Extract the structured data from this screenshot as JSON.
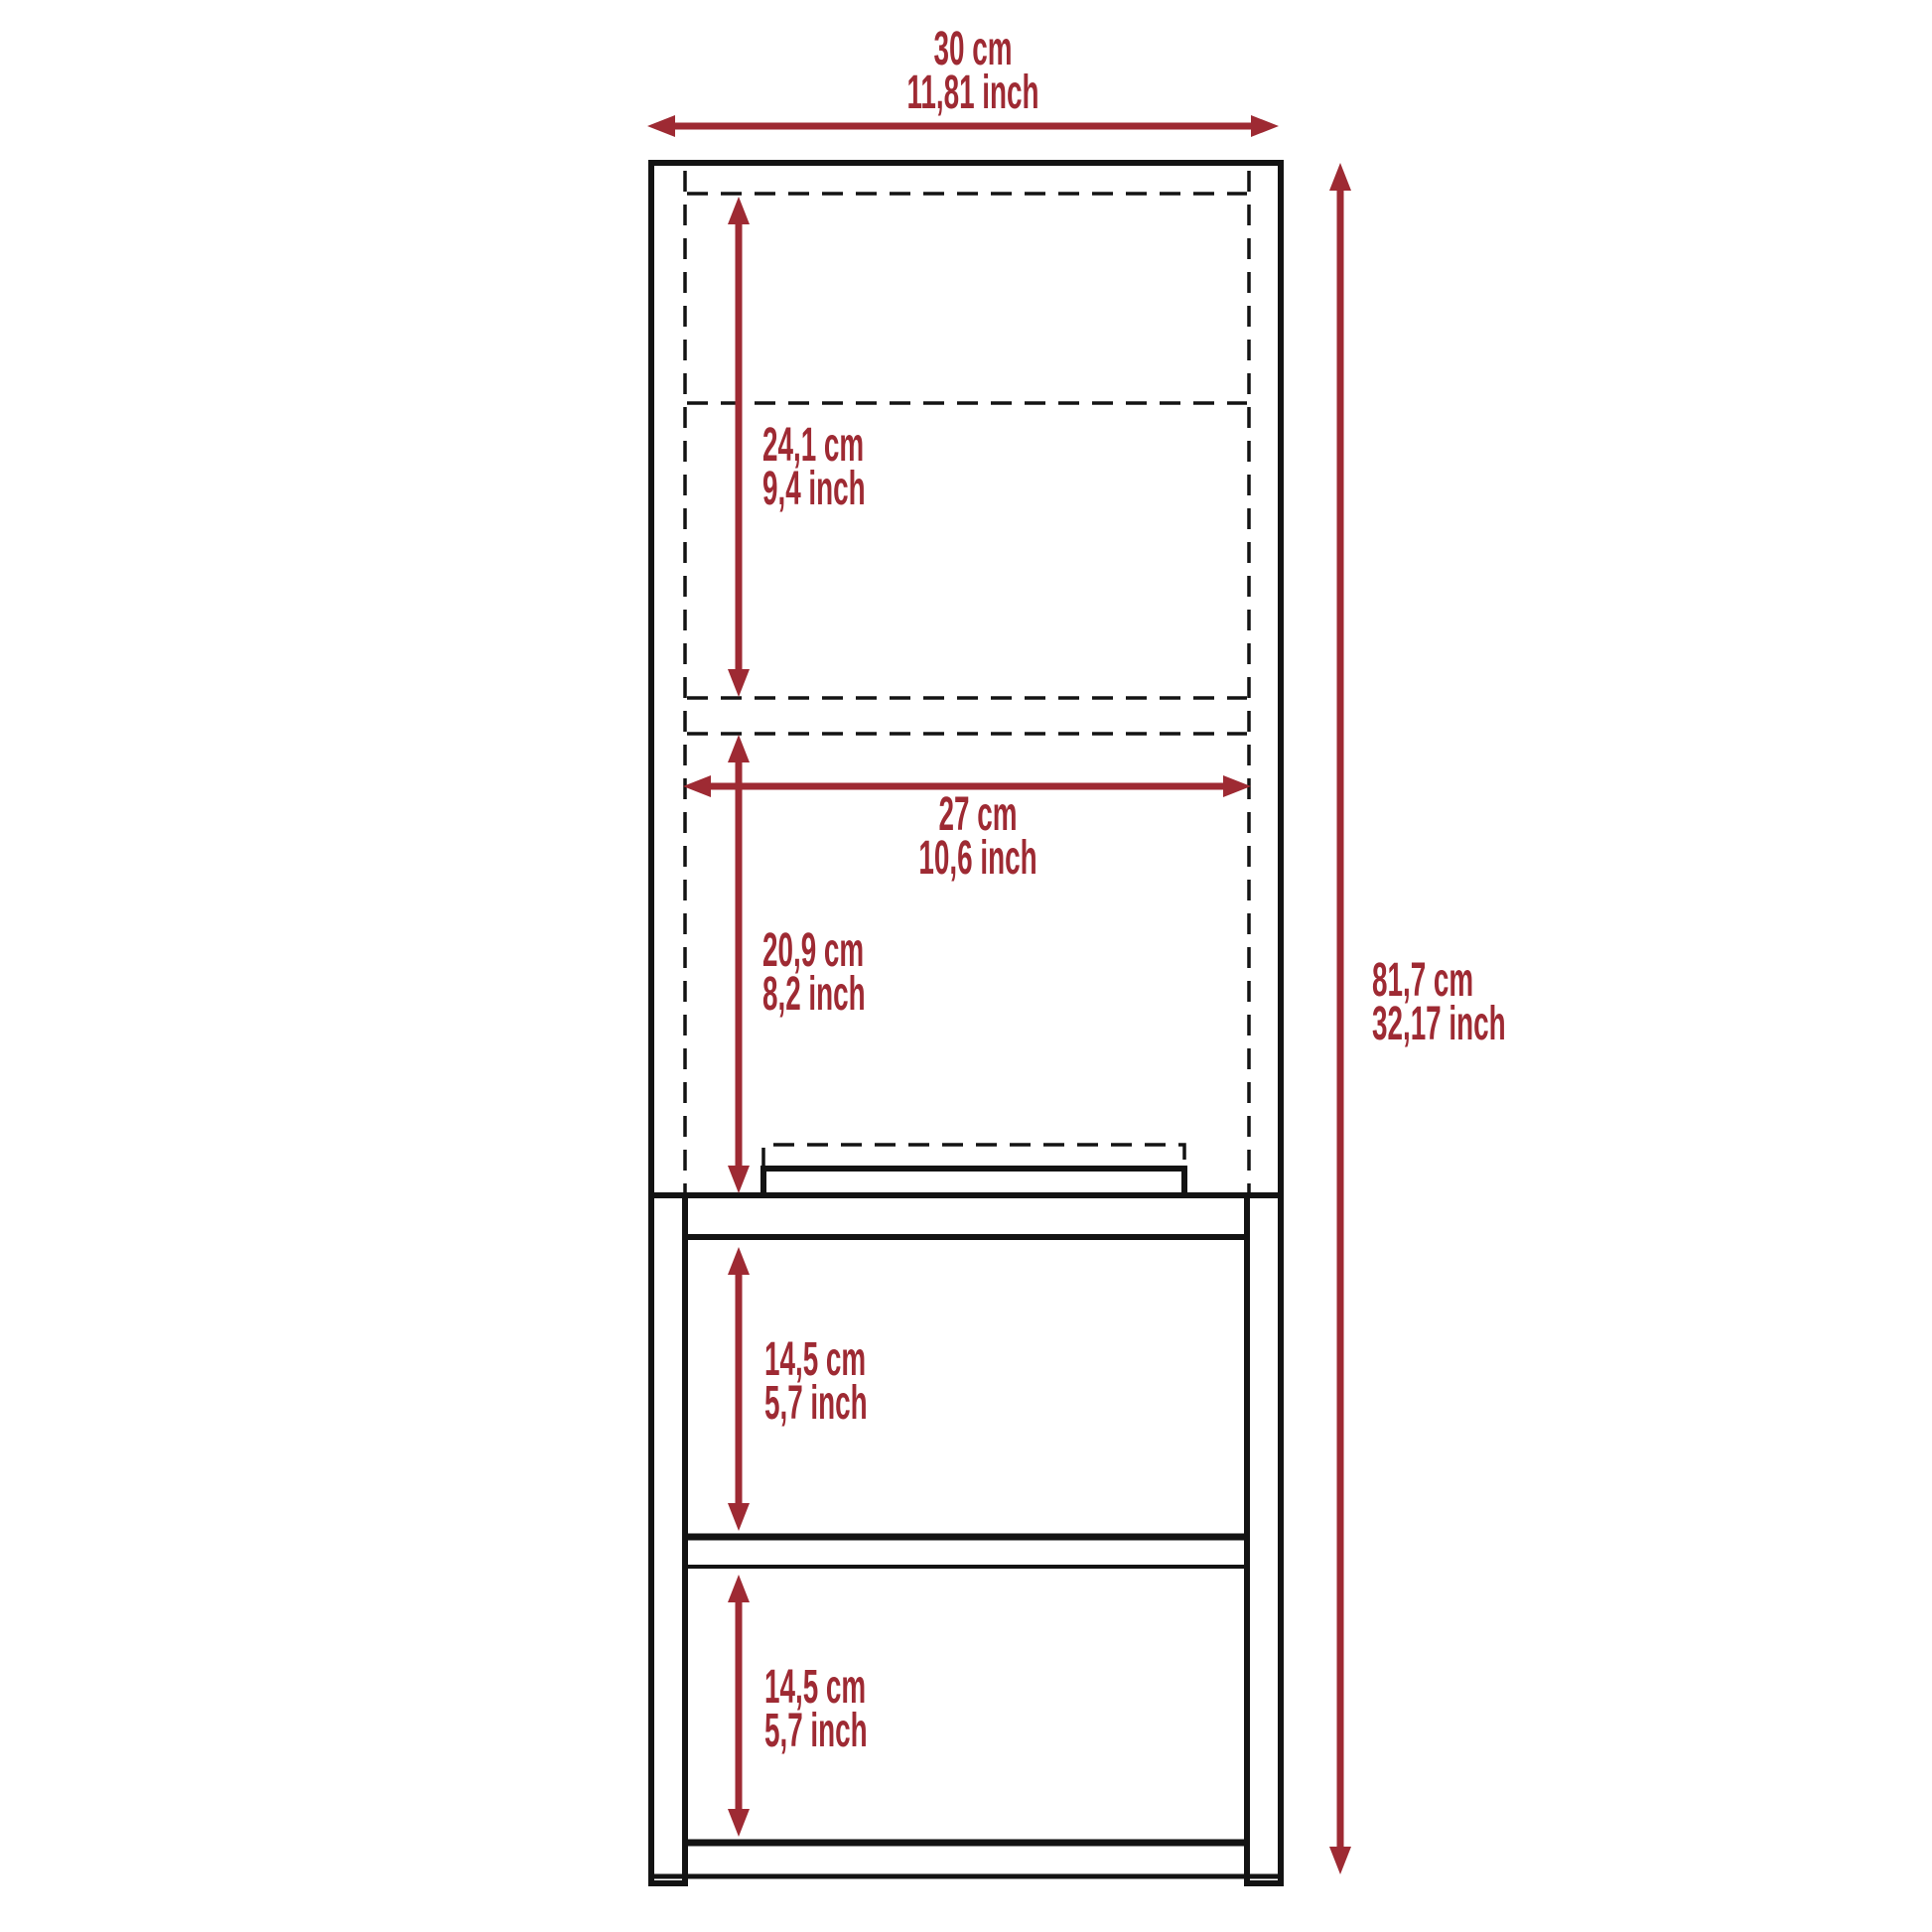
{
  "colors": {
    "accent": "#9e2a33",
    "line": "#131313",
    "background": "#ffffff"
  },
  "diagram": {
    "type": "furniture-dimension-drawing",
    "dimensions": {
      "overall_width": {
        "metric": "30 cm",
        "imperial": "11,81 inch"
      },
      "overall_height": {
        "metric": "81,7 cm",
        "imperial": "32,17 inch"
      },
      "upper_cavity_height": {
        "metric": "24,1 cm",
        "imperial": "9,4 inch"
      },
      "interior_width": {
        "metric": "27 cm",
        "imperial": "10,6 inch"
      },
      "lower_cavity_height": {
        "metric": "20,9 cm",
        "imperial": "8,2 inch"
      },
      "upper_shelf_height": {
        "metric": "14,5 cm",
        "imperial": "5,7 inch"
      },
      "lower_shelf_height": {
        "metric": "14,5 cm",
        "imperial": "5,7 inch"
      }
    }
  }
}
